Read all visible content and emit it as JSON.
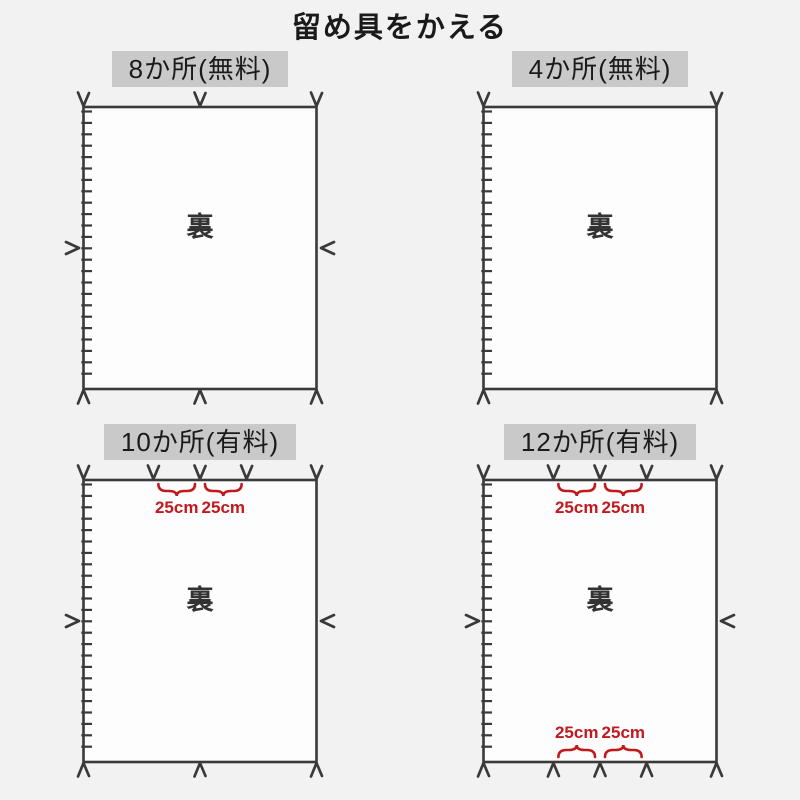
{
  "title": "留め具をかえる",
  "back_label": "裏",
  "dimension_label": "25cm",
  "colors": {
    "background": "#f2f2f2",
    "panel_fill": "#fdfdfd",
    "line": "#3a3a3a",
    "header_bg": "#c9c9c9",
    "text": "#1a1a1a",
    "accent_red": "#c2191d"
  },
  "panels": [
    {
      "id": "8-places-free",
      "header": "8か所(無料)",
      "top_marks": [
        0,
        0.5,
        1
      ],
      "bottom_marks": [
        0,
        0.5,
        1
      ],
      "side_marks": true,
      "top_braces": [],
      "bottom_braces": []
    },
    {
      "id": "4-places-free",
      "header": "4か所(無料)",
      "top_marks": [
        0,
        1
      ],
      "bottom_marks": [
        0,
        1
      ],
      "side_marks": false,
      "top_braces": [],
      "bottom_braces": []
    },
    {
      "id": "10-places-paid",
      "header": "10か所(有料)",
      "top_marks": [
        0,
        0.3,
        0.5,
        0.7,
        1
      ],
      "bottom_marks": [
        0,
        0.5,
        1
      ],
      "side_marks": true,
      "top_braces": [
        [
          0.3,
          0.5
        ],
        [
          0.5,
          0.7
        ]
      ],
      "bottom_braces": []
    },
    {
      "id": "12-places-paid",
      "header": "12か所(有料)",
      "top_marks": [
        0,
        0.3,
        0.5,
        0.7,
        1
      ],
      "bottom_marks": [
        0,
        0.3,
        0.5,
        0.7,
        1
      ],
      "side_marks": true,
      "top_braces": [
        [
          0.3,
          0.5
        ],
        [
          0.5,
          0.7
        ]
      ],
      "bottom_braces": [
        [
          0.3,
          0.5
        ],
        [
          0.5,
          0.7
        ]
      ]
    }
  ]
}
